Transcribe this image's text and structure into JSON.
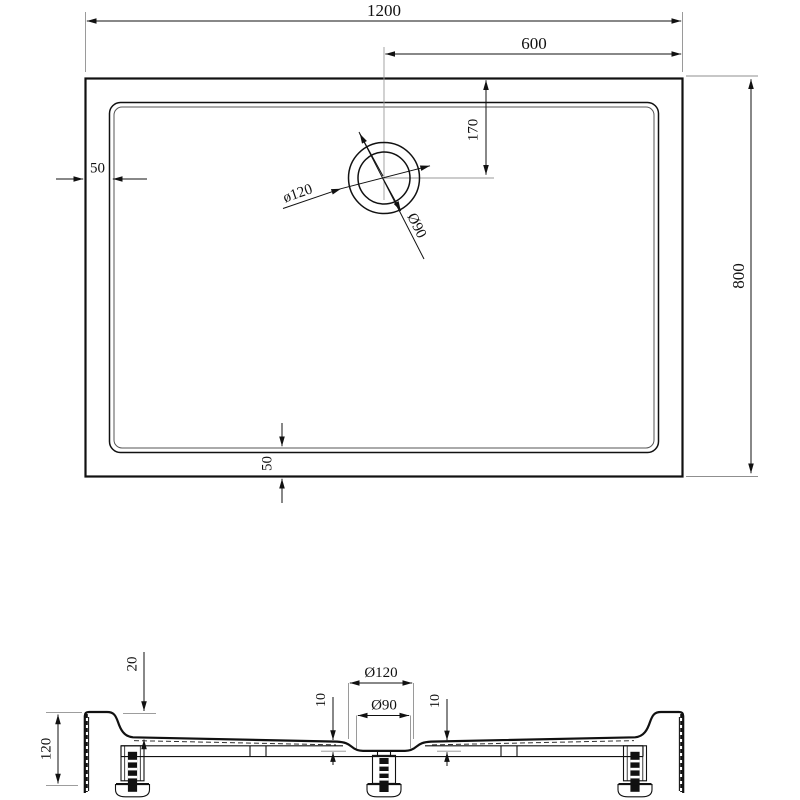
{
  "drawing_type": "shower-tray technical drawing, top view and cross-section",
  "colors": {
    "ink": "#111111",
    "thin_line": "#8f8f8f",
    "background": "#ffffff"
  },
  "top_view": {
    "labels": {
      "length": "1200",
      "drain_to_right": "600",
      "drain_from_top": "170",
      "margin_left": "50",
      "width": "800",
      "margin_bottom": "50",
      "drain_outer": "ø120",
      "drain_inner": "Ø90"
    }
  },
  "section_view": {
    "labels": {
      "rim_height": "20",
      "total_height": "120",
      "drain_outer": "Ø120",
      "drain_inner": "Ø90",
      "depth_left": "10",
      "depth_right": "10"
    }
  }
}
